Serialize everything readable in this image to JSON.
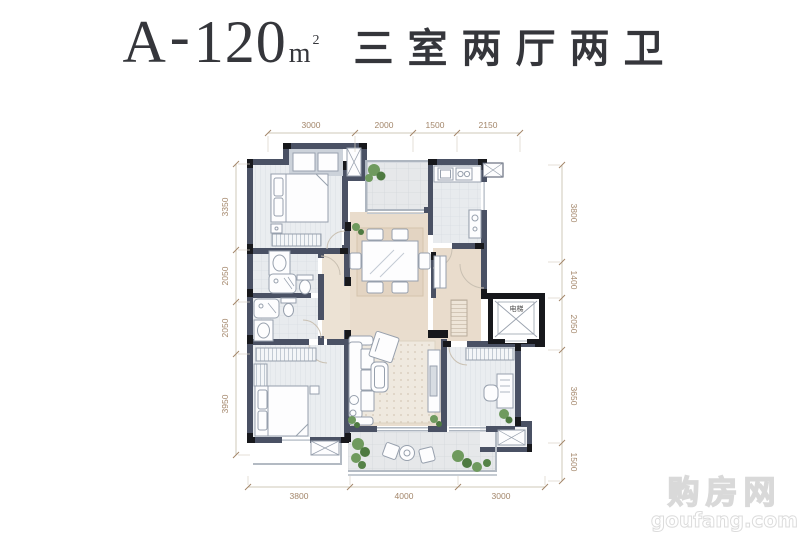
{
  "title": {
    "code": "A",
    "separator": "-",
    "area": "120",
    "unit": "m",
    "unit_exp": "2",
    "layout": "三室两厅两卫"
  },
  "dimensions": {
    "top": [
      "3000",
      "2000",
      "1500",
      "2150"
    ],
    "left": [
      "3350",
      "2050",
      "2050",
      "3950"
    ],
    "right": [
      "3800",
      "1400",
      "2050",
      "3650",
      "1500"
    ],
    "bottom": [
      "3800",
      "4000",
      "3000"
    ]
  },
  "plan": {
    "elevator_label": "电梯"
  },
  "watermark": {
    "name": "购房网",
    "domain": "goufang.com"
  },
  "colors": {
    "wall": "#4a5164",
    "wall_column": "#17181c",
    "floor_warm": "#e9dccc",
    "floor_plank": "#eaedf0",
    "floor_tile": "#e8ebee",
    "dim_text": "#a3866a",
    "plant": "#6f9a5e",
    "title_text": "#35363b"
  }
}
